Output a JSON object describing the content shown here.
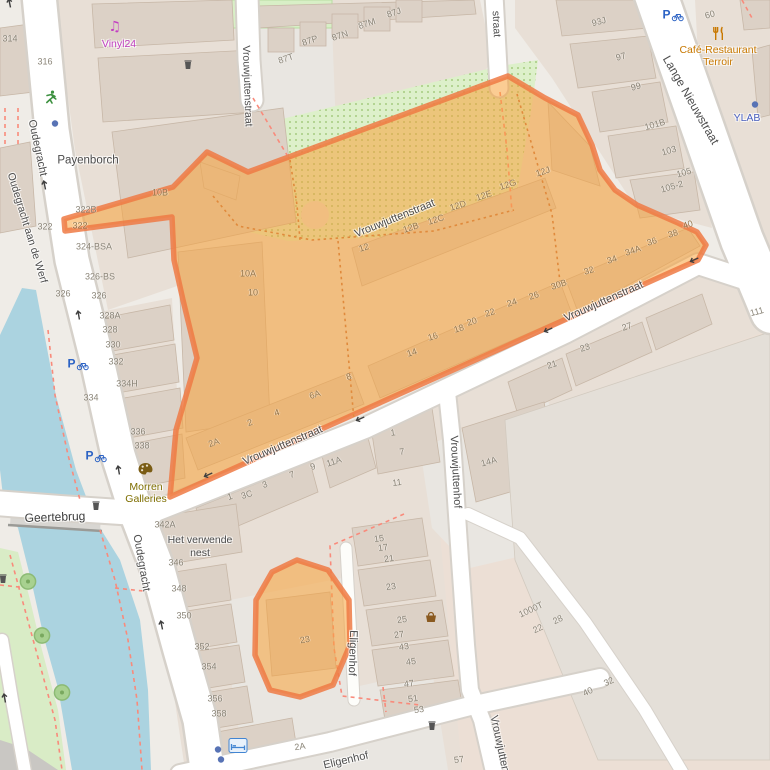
{
  "map_type": "street-map-with-highlighted-area",
  "colors": {
    "water": "#abd3e0",
    "road": "#ffffff",
    "road_casing": "#d6d1ca",
    "landuse_block": "#e8dfd6",
    "landuse_pink": "#ecdfd5",
    "plaza": "#e9e6e1",
    "building": "#dcd1c6",
    "building_outline": "#c7b7a7",
    "green_area": "#ddf0ca",
    "highlight_fill": "rgba(247,163,58,0.55)",
    "highlight_border": "rgba(239,122,68,0.85)",
    "footpath_dashed": "#f98a7b"
  },
  "street_labels": [
    {
      "text": "Oudegracht",
      "x": 37,
      "y": 148,
      "rot": 78
    },
    {
      "text": "Oudegracht aan de Werf",
      "x": 27,
      "y": 228,
      "rot": 73,
      "size": 10.5
    },
    {
      "text": "Oudegracht",
      "x": 141,
      "y": 563,
      "rot": 80
    },
    {
      "text": "Vrouwjuttenstraat",
      "x": 247,
      "y": 86,
      "rot": 88,
      "size": 10.5
    },
    {
      "text": "straat",
      "x": 496,
      "y": 24,
      "rot": 87,
      "size": 10.5
    },
    {
      "text": "Lange Nieuwstraat",
      "x": 691,
      "y": 100,
      "rot": 60,
      "size": 12
    },
    {
      "text": "Vrouwjuttenstraat",
      "x": 395,
      "y": 219,
      "rot": -22
    },
    {
      "text": "Vrouwjuttenstraat",
      "x": 283,
      "y": 446,
      "rot": -23
    },
    {
      "text": "Vrouwjuttenstraat",
      "x": 604,
      "y": 302,
      "rot": -24
    },
    {
      "text": "Vrouwjuttenhof",
      "x": 455,
      "y": 472,
      "rot": 87
    },
    {
      "text": "Vrouwjutten",
      "x": 499,
      "y": 744,
      "rot": 78
    },
    {
      "text": "Eligenhof",
      "x": 352,
      "y": 653,
      "rot": 92
    },
    {
      "text": "Eligenhof",
      "x": 346,
      "y": 761,
      "rot": -13
    },
    {
      "text": "Geertebrug",
      "x": 55,
      "y": 517,
      "rot": -2,
      "size": 12,
      "color": "#3c3c3c"
    }
  ],
  "place_labels": [
    {
      "text": "Vinyl24",
      "x": 119,
      "y": 44,
      "color": "#c03fc0"
    },
    {
      "text": "Payenborch",
      "x": 88,
      "y": 161,
      "size": 11.5
    },
    {
      "text": "Morren",
      "x": 146,
      "y": 487,
      "color": "#7e6e00"
    },
    {
      "text": "Galleries",
      "x": 146,
      "y": 499,
      "color": "#7e6e00"
    },
    {
      "text": "Café-Restaurant",
      "x": 718,
      "y": 50,
      "color": "#c87800"
    },
    {
      "text": "Terroir",
      "x": 718,
      "y": 62,
      "color": "#c87800"
    },
    {
      "text": "YLAB",
      "x": 747,
      "y": 118,
      "color": "#4a60c0"
    },
    {
      "text": "Het verwende",
      "x": 200,
      "y": 540
    },
    {
      "text": "nest",
      "x": 200,
      "y": 553
    }
  ],
  "house_numbers": [
    {
      "text": "314",
      "x": 10,
      "y": 39
    },
    {
      "text": "316",
      "x": 45,
      "y": 62
    },
    {
      "text": "322B",
      "x": 86,
      "y": 210
    },
    {
      "text": "322",
      "x": 45,
      "y": 227
    },
    {
      "text": "322",
      "x": 80,
      "y": 226,
      "color": "#96784f"
    },
    {
      "text": "324-BSA",
      "x": 94,
      "y": 247
    },
    {
      "text": "326-BS",
      "x": 100,
      "y": 277
    },
    {
      "text": "326",
      "x": 63,
      "y": 294
    },
    {
      "text": "326",
      "x": 99,
      "y": 296
    },
    {
      "text": "328A",
      "x": 110,
      "y": 316
    },
    {
      "text": "328",
      "x": 110,
      "y": 330
    },
    {
      "text": "330",
      "x": 113,
      "y": 345
    },
    {
      "text": "332",
      "x": 116,
      "y": 362
    },
    {
      "text": "334H",
      "x": 127,
      "y": 384
    },
    {
      "text": "334",
      "x": 91,
      "y": 398
    },
    {
      "text": "336",
      "x": 138,
      "y": 432
    },
    {
      "text": "338",
      "x": 142,
      "y": 446
    },
    {
      "text": "342A",
      "x": 165,
      "y": 525
    },
    {
      "text": "346",
      "x": 176,
      "y": 563
    },
    {
      "text": "348",
      "x": 179,
      "y": 589
    },
    {
      "text": "350",
      "x": 184,
      "y": 616
    },
    {
      "text": "352",
      "x": 202,
      "y": 647
    },
    {
      "text": "354",
      "x": 209,
      "y": 667
    },
    {
      "text": "356",
      "x": 215,
      "y": 699
    },
    {
      "text": "358",
      "x": 219,
      "y": 714
    },
    {
      "text": "87T",
      "x": 286,
      "y": 59,
      "rot": -18
    },
    {
      "text": "87P",
      "x": 310,
      "y": 41,
      "rot": -18
    },
    {
      "text": "87N",
      "x": 340,
      "y": 36,
      "rot": -18
    },
    {
      "text": "87M",
      "x": 367,
      "y": 24,
      "rot": -18
    },
    {
      "text": "87J",
      "x": 394,
      "y": 13,
      "rot": -18
    },
    {
      "text": "93J",
      "x": 599,
      "y": 22,
      "rot": -15
    },
    {
      "text": "97",
      "x": 621,
      "y": 57,
      "rot": -15
    },
    {
      "text": "99",
      "x": 636,
      "y": 87,
      "rot": -15
    },
    {
      "text": "101B",
      "x": 655,
      "y": 125,
      "rot": -16
    },
    {
      "text": "103",
      "x": 669,
      "y": 151,
      "rot": -16
    },
    {
      "text": "105",
      "x": 684,
      "y": 173,
      "rot": -16
    },
    {
      "text": "105-2",
      "x": 672,
      "y": 187,
      "rot": -16
    },
    {
      "text": "60",
      "x": 710,
      "y": 15,
      "rot": -15
    },
    {
      "text": "10B",
      "x": 160,
      "y": 193,
      "color": "#96784f"
    },
    {
      "text": "10A",
      "x": 248,
      "y": 274,
      "color": "#96784f"
    },
    {
      "text": "10",
      "x": 253,
      "y": 293,
      "color": "#96784f"
    },
    {
      "text": "12",
      "x": 364,
      "y": 248,
      "rot": -18,
      "color": "#96784f"
    },
    {
      "text": "12B",
      "x": 411,
      "y": 228,
      "rot": -18,
      "color": "#96784f"
    },
    {
      "text": "12C",
      "x": 436,
      "y": 220,
      "rot": -18,
      "color": "#96784f"
    },
    {
      "text": "12D",
      "x": 458,
      "y": 206,
      "rot": -18,
      "color": "#96784f"
    },
    {
      "text": "12E",
      "x": 484,
      "y": 196,
      "rot": -18,
      "color": "#96784f"
    },
    {
      "text": "12G",
      "x": 508,
      "y": 185,
      "rot": -18,
      "color": "#96784f"
    },
    {
      "text": "12J",
      "x": 543,
      "y": 172,
      "rot": -18,
      "color": "#96784f"
    },
    {
      "text": "2A",
      "x": 214,
      "y": 443,
      "rot": -18,
      "color": "#96784f"
    },
    {
      "text": "2",
      "x": 250,
      "y": 423,
      "rot": -18,
      "color": "#96784f"
    },
    {
      "text": "4",
      "x": 277,
      "y": 413,
      "rot": -18,
      "color": "#96784f"
    },
    {
      "text": "6A",
      "x": 315,
      "y": 395,
      "rot": -18,
      "color": "#96784f"
    },
    {
      "text": "8",
      "x": 349,
      "y": 377,
      "rot": -18,
      "color": "#96784f"
    },
    {
      "text": "14",
      "x": 412,
      "y": 353,
      "rot": -18,
      "color": "#96784f"
    },
    {
      "text": "16",
      "x": 433,
      "y": 337,
      "rot": -18,
      "color": "#96784f"
    },
    {
      "text": "18",
      "x": 459,
      "y": 329,
      "rot": -18,
      "color": "#96784f"
    },
    {
      "text": "20",
      "x": 472,
      "y": 322,
      "rot": -18,
      "color": "#96784f"
    },
    {
      "text": "22",
      "x": 490,
      "y": 313,
      "rot": -18,
      "color": "#96784f"
    },
    {
      "text": "24",
      "x": 512,
      "y": 303,
      "rot": -18,
      "color": "#96784f"
    },
    {
      "text": "26",
      "x": 534,
      "y": 296,
      "rot": -18,
      "color": "#96784f"
    },
    {
      "text": "30B",
      "x": 559,
      "y": 285,
      "rot": -18,
      "color": "#96784f"
    },
    {
      "text": "32",
      "x": 589,
      "y": 271,
      "rot": -18,
      "color": "#96784f"
    },
    {
      "text": "34",
      "x": 612,
      "y": 260,
      "rot": -18,
      "color": "#96784f"
    },
    {
      "text": "34A",
      "x": 633,
      "y": 251,
      "rot": -18,
      "color": "#96784f"
    },
    {
      "text": "36",
      "x": 652,
      "y": 242,
      "rot": -18,
      "color": "#96784f"
    },
    {
      "text": "38",
      "x": 673,
      "y": 234,
      "rot": -18,
      "color": "#96784f"
    },
    {
      "text": "40",
      "x": 688,
      "y": 225,
      "rot": -18,
      "color": "#96784f"
    },
    {
      "text": "1",
      "x": 230,
      "y": 497,
      "rot": -18
    },
    {
      "text": "3C",
      "x": 247,
      "y": 495,
      "rot": -18
    },
    {
      "text": "3",
      "x": 265,
      "y": 485,
      "rot": -18
    },
    {
      "text": "7",
      "x": 292,
      "y": 475,
      "rot": -18
    },
    {
      "text": "9",
      "x": 313,
      "y": 467,
      "rot": -18
    },
    {
      "text": "11A",
      "x": 334,
      "y": 462,
      "rot": -18
    },
    {
      "text": "1",
      "x": 393,
      "y": 433,
      "rot": -8
    },
    {
      "text": "7",
      "x": 402,
      "y": 452,
      "rot": -8
    },
    {
      "text": "11",
      "x": 397,
      "y": 483,
      "rot": -8
    },
    {
      "text": "14A",
      "x": 489,
      "y": 462,
      "rot": -15
    },
    {
      "text": "21",
      "x": 552,
      "y": 365,
      "rot": -18
    },
    {
      "text": "23",
      "x": 585,
      "y": 348,
      "rot": -18
    },
    {
      "text": "27",
      "x": 627,
      "y": 327,
      "rot": -18
    },
    {
      "text": "111",
      "x": 757,
      "y": 312,
      "rot": -15
    },
    {
      "text": "15",
      "x": 379,
      "y": 539,
      "rot": -8
    },
    {
      "text": "17",
      "x": 383,
      "y": 548,
      "rot": -8
    },
    {
      "text": "21",
      "x": 389,
      "y": 559,
      "rot": -8
    },
    {
      "text": "23",
      "x": 391,
      "y": 587,
      "rot": -8
    },
    {
      "text": "25",
      "x": 402,
      "y": 620,
      "rot": -8
    },
    {
      "text": "27",
      "x": 399,
      "y": 635,
      "rot": -8
    },
    {
      "text": "43",
      "x": 404,
      "y": 647,
      "rot": -8
    },
    {
      "text": "45",
      "x": 411,
      "y": 662,
      "rot": -8
    },
    {
      "text": "47",
      "x": 409,
      "y": 684,
      "rot": -8
    },
    {
      "text": "51",
      "x": 413,
      "y": 699,
      "rot": -8
    },
    {
      "text": "53",
      "x": 419,
      "y": 710,
      "rot": -8
    },
    {
      "text": "57",
      "x": 459,
      "y": 760,
      "rot": -8
    },
    {
      "text": "23",
      "x": 305,
      "y": 640,
      "rot": -10,
      "color": "#96784f"
    },
    {
      "text": "2A",
      "x": 300,
      "y": 747,
      "rot": -8
    },
    {
      "text": "1000T",
      "x": 531,
      "y": 610,
      "rot": -25
    },
    {
      "text": "28",
      "x": 558,
      "y": 620,
      "rot": -25
    },
    {
      "text": "22",
      "x": 538,
      "y": 629,
      "rot": -25
    },
    {
      "text": "32",
      "x": 609,
      "y": 682,
      "rot": -25
    },
    {
      "text": "40",
      "x": 588,
      "y": 692,
      "rot": -25
    }
  ],
  "icons": [
    {
      "type": "oneway-arrow",
      "x": 10,
      "y": 5,
      "rot": -12
    },
    {
      "type": "oneway-arrow",
      "x": 45,
      "y": 187,
      "rot": -12
    },
    {
      "type": "oneway-arrow",
      "x": 79,
      "y": 317,
      "rot": -10
    },
    {
      "type": "oneway-arrow",
      "x": 119,
      "y": 472,
      "rot": -10
    },
    {
      "type": "oneway-arrow",
      "x": 162,
      "y": 627,
      "rot": -12
    },
    {
      "type": "oneway-arrow",
      "x": 5,
      "y": 700,
      "rot": -10
    },
    {
      "type": "oneway-arrow",
      "x": 210,
      "y": 474,
      "rot": -114
    },
    {
      "type": "oneway-arrow",
      "x": 362,
      "y": 418,
      "rot": -114
    },
    {
      "type": "oneway-arrow",
      "x": 550,
      "y": 329,
      "rot": -114
    },
    {
      "type": "oneway-arrow",
      "x": 696,
      "y": 259,
      "rot": -114
    },
    {
      "type": "bicycle-parking",
      "x": 78,
      "y": 366
    },
    {
      "type": "bicycle-parking",
      "x": 96,
      "y": 458
    },
    {
      "type": "bicycle-parking",
      "x": 673,
      "y": 17
    },
    {
      "type": "music-shop",
      "x": 116,
      "y": 28
    },
    {
      "type": "runner",
      "x": 51,
      "y": 100
    },
    {
      "type": "art-gallery",
      "x": 146,
      "y": 472
    },
    {
      "type": "restaurant",
      "x": 719,
      "y": 36
    },
    {
      "type": "marketplace-basket",
      "x": 431,
      "y": 619
    },
    {
      "type": "hostel-bed",
      "x": 238,
      "y": 748
    },
    {
      "type": "waste-bin",
      "x": 188,
      "y": 66
    },
    {
      "type": "waste-bin",
      "x": 96,
      "y": 507
    },
    {
      "type": "waste-bin",
      "x": 432,
      "y": 727
    },
    {
      "type": "waste-bin",
      "x": 3,
      "y": 580
    },
    {
      "type": "tree",
      "x": 28,
      "y": 584
    },
    {
      "type": "tree",
      "x": 42,
      "y": 638
    },
    {
      "type": "tree",
      "x": 62,
      "y": 695
    },
    {
      "type": "poi-dot",
      "x": 55,
      "y": 124
    },
    {
      "type": "poi-dot",
      "x": 755,
      "y": 105
    },
    {
      "type": "poi-dot",
      "x": 218,
      "y": 750
    },
    {
      "type": "poi-dot",
      "x": 221,
      "y": 760
    }
  ]
}
